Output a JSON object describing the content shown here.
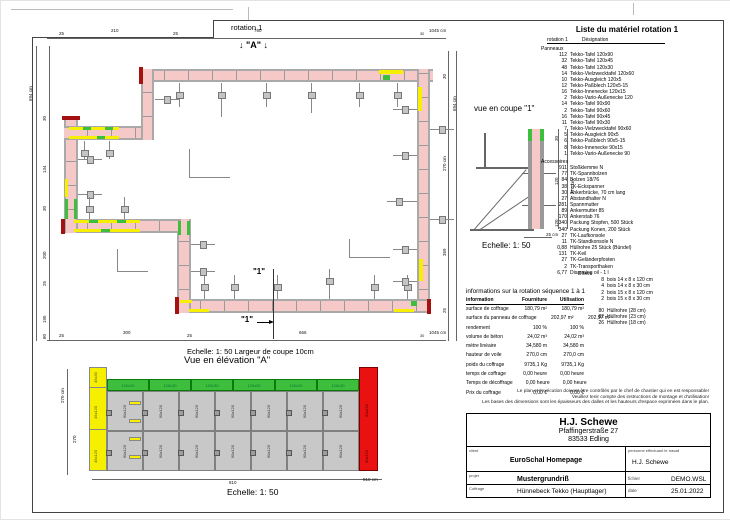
{
  "plan": {
    "title": "rotation 1",
    "marker_a": "↓ \"A\" ↓",
    "cut_marker": "\"1\"",
    "scale_note": "Echelle: 1: 50   Largeur de coupe 10cm",
    "dim_top": {
      "segments": [
        "25",
        "210",
        "25",
        "760",
        "30"
      ],
      "total": "1045 cm"
    },
    "dim_bottom": {
      "segments": [
        "25",
        "300",
        "25",
        "666",
        "30"
      ],
      "total": "1045 cm"
    },
    "dim_left": {
      "total": "694 cm",
      "segments": [
        "30",
        "134",
        "30",
        "200",
        "25",
        "195",
        "80"
      ]
    },
    "dim_right": {
      "total": "694 cm",
      "segments": [
        "30",
        "270 cm",
        "369",
        "25"
      ]
    }
  },
  "elevation": {
    "title": "Vue en élévation \"A\"",
    "scale": "Echelle: 1: 50",
    "dim_height_total": "270 cm",
    "dim_height_segment": "270",
    "dim_width_segment": "810",
    "dim_width_total": "810 cm",
    "green_panel_label": "120x30",
    "green_panel_count": 6,
    "gray_panel_label": "90x120",
    "gray_cols": 7,
    "gray_rows": 2,
    "yellow_panel_labels": [
      "45x30",
      "45x120",
      "45x120"
    ],
    "red_panel_label": "90x120"
  },
  "section": {
    "title": "vue en coupe \"1\"",
    "scale": "Echelle: 1: 50",
    "dim_total": "270 cm",
    "dim_segments": [
      "30",
      "120",
      "120"
    ],
    "dim_width": "25 cm"
  },
  "material_list": {
    "title": "Liste du matériel  rotation 1",
    "col1": "rotation 1",
    "col2": "Désignation",
    "groups": [
      {
        "name": "Panneaux",
        "items": [
          [
            "112",
            "Tekko-Tafel 120x90"
          ],
          [
            "32",
            "Tekko-Tafel 120x45"
          ],
          [
            "48",
            "Tekko-Tafel 120x30"
          ],
          [
            "14",
            "Tekko-Vielzwecktafel 120x60"
          ],
          [
            "10",
            "Tekko-Ausgleich 120x5"
          ],
          [
            "12",
            "Tekko-Paßblech 120x5-15"
          ],
          [
            "16",
            "Tekko-Innenecke 120x15"
          ],
          [
            "2",
            "Tekko-Vario-Außenecke 120"
          ],
          [
            "14",
            "Tekko-Tafel 90x90"
          ],
          [
            "2",
            "Tekko-Tafel 90x60"
          ],
          [
            "16",
            "Tekko-Tafel 90x45"
          ],
          [
            "11",
            "Tekko-Tafel 90x30"
          ],
          [
            "7",
            "Tekko-Vielzwecktafel 90x60"
          ],
          [
            "5",
            "Tekko-Ausgleich 90x5"
          ],
          [
            "6",
            "Tekko-Paßblech 90x5-15"
          ],
          [
            "8",
            "Tekko-Innenecke 90x15"
          ],
          [
            "1",
            "Tekko-Vario-Außenecke 90"
          ]
        ]
      },
      {
        "name": "Accessoires",
        "items": [
          [
            "911",
            "Stoßklemme N"
          ],
          [
            "77",
            "TK-Spannbolzen"
          ],
          [
            "84",
            "Bolzen 18/76"
          ],
          [
            "38",
            "TK-Eckspanner"
          ],
          [
            "30",
            "Ankerbrücke, 70 cm lang"
          ],
          [
            "27",
            "Abstandhalter N"
          ],
          [
            "281",
            "Spannmutter"
          ],
          [
            "89",
            "Ankermutter 85"
          ],
          [
            "170",
            "Ankerstab 76"
          ],
          [
            "340",
            "Packung Stopfen, 500 Stück"
          ],
          [
            "340",
            "Packung Konen, 200 Stück"
          ],
          [
            "27",
            "TK-Laufkonsole"
          ],
          [
            "11",
            "TK-Standkonsole N"
          ],
          [
            "0,88",
            "Hüllrohre 25 Stück (Bündel)"
          ],
          [
            "131",
            "TK-Keil"
          ],
          [
            "27",
            "TK-Geländerpfosten"
          ],
          [
            "2",
            "TK-Transporthaken"
          ],
          [
            "6,77",
            "Disarming oil - 1 l"
          ]
        ]
      }
    ],
    "divers": {
      "name": "Divers",
      "items": [
        [
          "8",
          "bois 14 x 8 x 120 cm"
        ],
        [
          "4",
          "bois 14 x 8 x 30 cm"
        ],
        [
          "2",
          "bois 15 x 8 x 120 cm"
        ],
        [
          "2",
          "bois 15 x 8 x 30 cm"
        ]
      ]
    },
    "hullrohre": [
      [
        "80",
        "Hüllrohre (28 cm)"
      ],
      [
        "82",
        "Hüllrohre (23 cm)"
      ],
      [
        "26",
        "Hüllrohre (18 cm)"
      ]
    ]
  },
  "info_table": {
    "title": "informations sur la rotation  séquence 1 à 1",
    "columns": [
      "information",
      "Fourniture",
      "Utilisation"
    ],
    "rows": [
      [
        "surface de coffrage",
        "180,79 m²",
        "180,79 m²"
      ],
      [
        "surface du panneau de coffrage",
        "202,97 m²",
        "202,97 m²"
      ],
      [
        "rendement",
        "100 %",
        "100 %"
      ],
      [
        "volume de béton",
        "24,02 m³",
        "24,02 m³"
      ],
      [
        "mètre linéaire",
        "34,580 m",
        "34,580 m"
      ],
      [
        "hauteur de voile",
        "270,0 cm",
        "270,0 cm"
      ],
      [
        "poids du coffrage",
        "9735,1 Kg",
        "9735,1 Kg"
      ],
      [
        "temps de coffrage",
        "0,00 heure",
        "0,00 heure"
      ],
      [
        "Temps de décoffrage",
        "0,00 heure",
        "0,00 heure"
      ],
      [
        "Prix du coffrage",
        "0,00 €",
        "0,00 €"
      ]
    ]
  },
  "disclaimer": [
    "Le plan et l'exécution doivent être contrôlés par le chef de chantier qui en est responsable!",
    "Veuillez tenir compte des instructions de montage et d'utilisation!",
    "Les bases des dimensions sont les épaisseurs des dalles et les hauteurs d'espace exprimées dans le plan."
  ],
  "title_block": {
    "company_name": "H.J. Schewe",
    "company_addr1": "Pfaffingerstraße 27",
    "company_addr2": "83533 Edling",
    "client_label": "client",
    "client_value": "EuroSchal Homepage",
    "worker_label": "personne effectuant le travail",
    "worker_value": "H.J. Schewe",
    "project_label": "projet",
    "project_value": "Mustergrundriß",
    "file_label": "fichier",
    "file_value": "DEMO.WSL",
    "formwork_label": "Coffrage",
    "formwork_value": "Hünnebeck Tekko (Hauptlager)",
    "date_label": "date",
    "date_value": "25.01.2022"
  },
  "colors": {
    "wall_pink": "#f6c9c9",
    "panel_yellow": "#f6ef00",
    "panel_green": "#3dbf3d",
    "panel_red": "#ea1111",
    "cap_dark_red": "#a31111",
    "formwork_gray": "#8c8c8c"
  }
}
